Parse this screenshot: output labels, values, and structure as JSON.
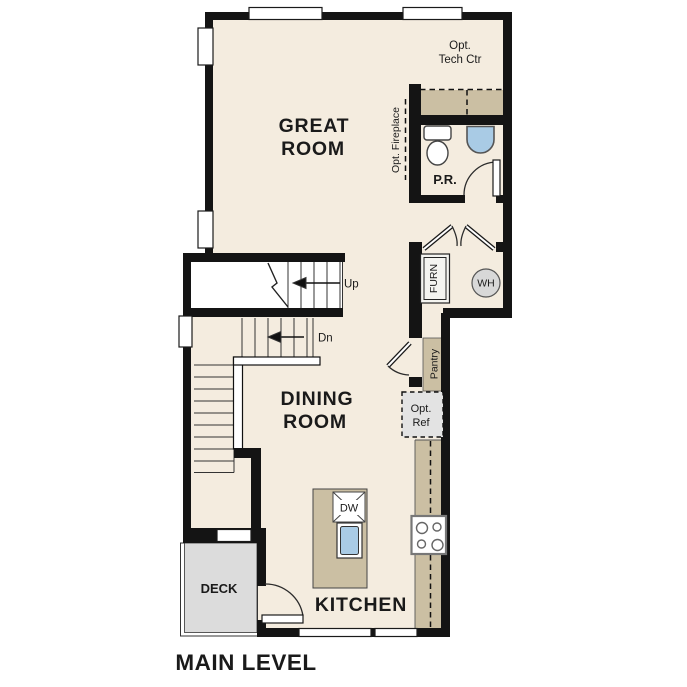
{
  "title": "MAIN LEVEL",
  "colors": {
    "floor": "#f4ecdf",
    "wall": "#141414",
    "counter": "#cbbfa3",
    "deck": "#dcdcdc",
    "water": "#a9cbe5",
    "appliance": "#d8d8d8",
    "ref_fill": "#e3e3e3",
    "stair": "#ffffff",
    "text": "#1a1a1a"
  },
  "rooms": {
    "great_room": {
      "line1": "GREAT",
      "line2": "ROOM"
    },
    "dining_room": {
      "line1": "DINING",
      "line2": "ROOM"
    },
    "kitchen": {
      "label": "KITCHEN"
    },
    "powder_room": {
      "label": "P.R."
    },
    "deck": {
      "label": "DECK"
    }
  },
  "stairs": {
    "up_label": "Up",
    "down_label": "Dn"
  },
  "equipment": {
    "furnace": "FURN",
    "water_heater": "WH",
    "dishwasher": "DW",
    "pantry": "Pantry",
    "opt_ref": {
      "line1": "Opt.",
      "line2": "Ref"
    },
    "opt_tech_ctr": {
      "line1": "Opt.",
      "line2": "Tech Ctr"
    },
    "opt_fireplace": "Opt. Fireplace"
  }
}
